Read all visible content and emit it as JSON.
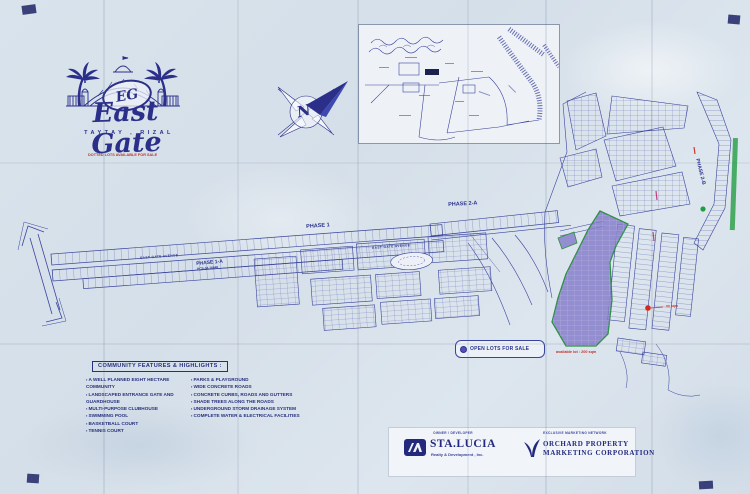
{
  "branding": {
    "monogram": "EG",
    "name": "East Gate",
    "location": "TAYTAY , RIZAL",
    "red_note": "DOTTED LOTS AVAILABLE FOR SALE"
  },
  "compass": {
    "letter": "N"
  },
  "map": {
    "phase_1a": "PHASE 1-A",
    "phase_1a_sub": "PCS-04-16640",
    "phase_1": "PHASE 1",
    "phase_2a": "PHASE 2-A",
    "phase_2b": "PHASE 2-B",
    "avenue": "EAST GATE AVENUE",
    "legend_label": "OPEN LOTS FOR SALE",
    "available_note": "available lot : 200 sqm",
    "marker_note": "xx sqm"
  },
  "features": {
    "title": "COMMUNITY FEATURES & HIGHLIGHTS :",
    "col1": [
      "A WELL PLANNED EIGHT HECTARE COMMUNITY",
      "LANDSCAPED ENTRANCE GATE AND GUARDHOUSE",
      "MULTI-PURPOSE CLUBHOUSE",
      "SWIMMING POOL",
      "BASKETBALL COURT",
      "TENNIS COURT"
    ],
    "col2": [
      "PARKS & PLAYGROUND",
      "WIDE CONCRETE ROADS",
      "CONCRETE CURBS, ROADS AND GUTTERS",
      "SHADE TREES ALONG THE ROADS",
      "UNDERGROUND STORM DRAINAGE SYSTEM",
      "COMPLETE WATER & ELECTRICAL FACILITIES"
    ]
  },
  "developer": {
    "caption": "OWNER / DEVELOPER",
    "name": "STA.LUCIA",
    "sub": "Realty & Development , Inc."
  },
  "marketing": {
    "caption": "EXCLUSIVE MARKETING NETWORK",
    "line1": "ORCHARD PROPERTY",
    "line2": "MARKETING CORPORATION"
  },
  "colors": {
    "ink": "#2b2f8a",
    "map_ink": "#3a449e",
    "open_lots_fill": "#837ac8",
    "open_lots_edge": "#2e8f46",
    "marker_red": "#d42a1e",
    "marker_green": "#1f9e45"
  }
}
